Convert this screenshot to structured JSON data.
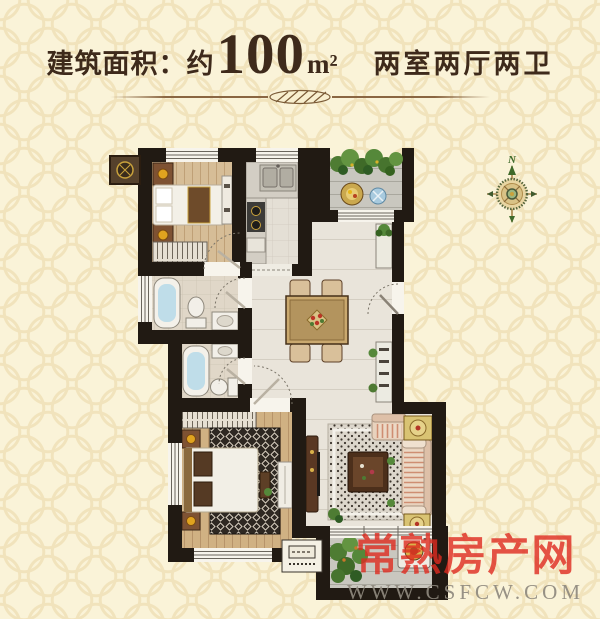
{
  "header": {
    "area_prefix": "建筑面积：约",
    "area_value": "100",
    "area_unit": "m²",
    "layout_spec": "两室两厅两卫"
  },
  "compass": {
    "north_label": "N"
  },
  "watermark": {
    "site_name": "常熟房产网",
    "site_url": "WWW.CSFCW.COM"
  },
  "colors": {
    "background_cream": "#faf3d8",
    "background_pattern": "#f1e3bc",
    "title_text": "#3e2a1b",
    "divider_brown": "#8a6642",
    "wall_black": "#211a13",
    "wood_floor_light": "#d6bd97",
    "wood_floor_master": "#d0b183",
    "tile_floor": "#e9e4da",
    "bath_floor": "#e0d7c8",
    "balcony_floor": "#c9c7bf",
    "water_blue": "#bfdde9",
    "accent_gold": "#d9b24a",
    "plant_green": "#55883a",
    "sofa_stripe": "#cf8e72",
    "watermark_red": "#df2b20",
    "watermark_gray": "#8f897e"
  }
}
